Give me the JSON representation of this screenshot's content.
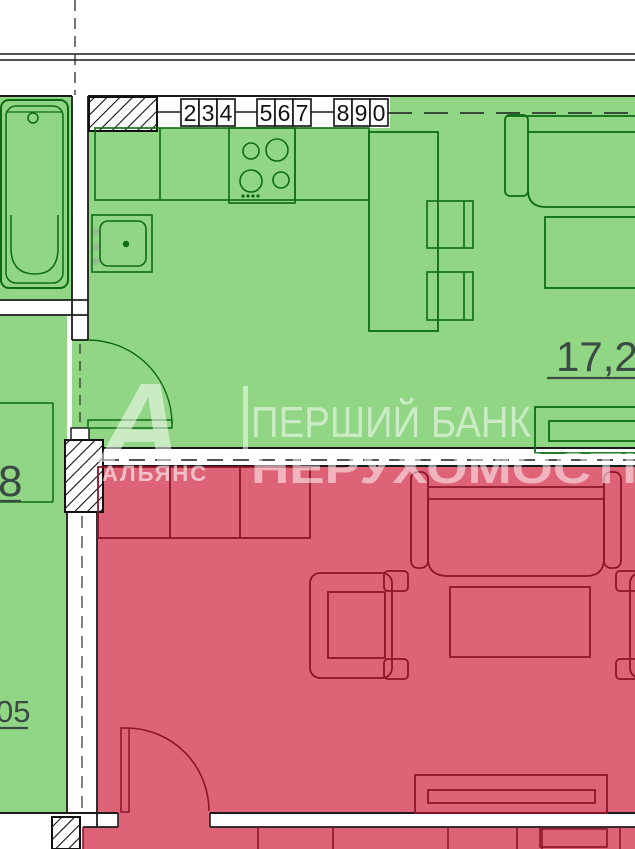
{
  "floor_plan": {
    "watermark": {
      "logo_letter": "А",
      "logo_caption": "АЛЬЯНС",
      "title_line1": "ПЕРШИЙ БАНК",
      "title_line2": "НЕРУХОМОСТІ"
    },
    "area_labels": {
      "kitchen_living": "17,28",
      "room_left_upper": "8",
      "room_left_lower": "05"
    },
    "marker_digits": [
      "2",
      "3",
      "4",
      "5",
      "6",
      "7",
      "8",
      "9",
      "0"
    ],
    "colors": {
      "room_green_fill": "#90d685",
      "room_green_line": "#0e6b14",
      "room_red_fill": "#df6377",
      "room_red_line": "#8a1628",
      "wall_line": "#1c1c1c",
      "label_text": "#3a4a44",
      "watermark_text": "#ffffff"
    }
  }
}
